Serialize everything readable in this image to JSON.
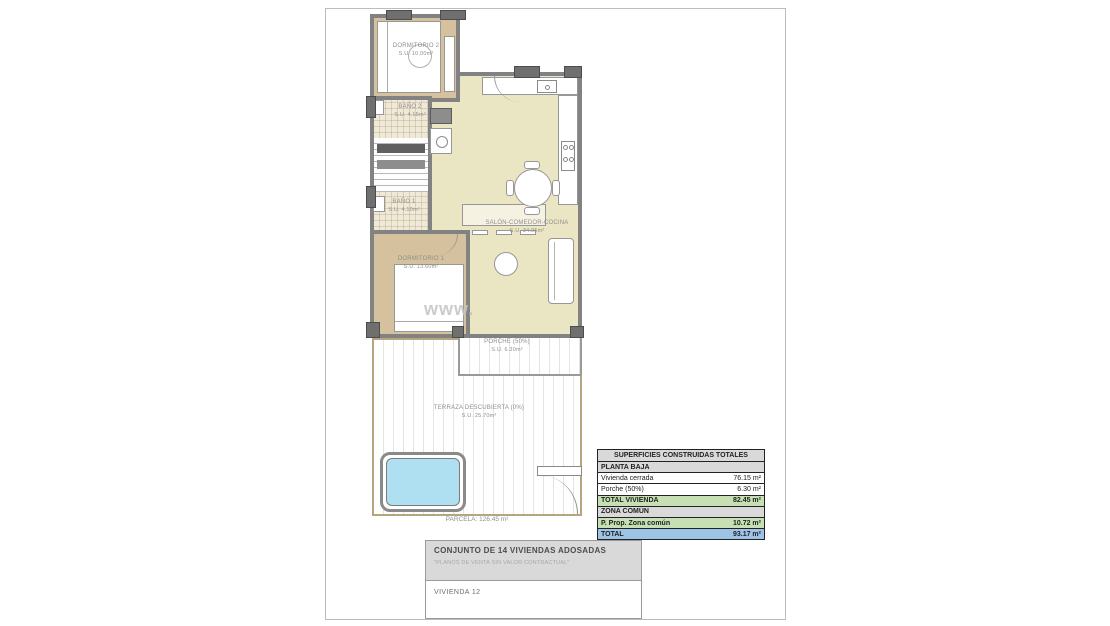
{
  "watermark": {
    "text": "www."
  },
  "plan": {
    "rooms": [
      {
        "name": "DORMITORIO 2",
        "area": "S.U. 10.00m²"
      },
      {
        "name": "BAÑO 2",
        "area": "S.U. 4.15m²"
      },
      {
        "name": "BAÑO 1",
        "area": "S.U. 4.10m²"
      },
      {
        "name": "SALÓN-COMEDOR-COCINA",
        "area": "S.U. 34.05m²"
      },
      {
        "name": "DORMITORIO 1",
        "area": "S.U. 13.60m²"
      },
      {
        "name": "PORCHE (50%)",
        "area": "S.U. 6.30m²"
      },
      {
        "name": "TERRAZA DESCUBIERTA (0%)",
        "area": "S.U. 25.70m²"
      }
    ],
    "parcela_label": "PARCELA: 126.45 m²"
  },
  "areas_table": {
    "header": "SUPERFICIES CONSTRUIDAS TOTALES",
    "rows": [
      {
        "label": "PLANTA BAJA",
        "value": ""
      },
      {
        "label": "Vivienda cerrada",
        "value": "76.15 m²"
      },
      {
        "label": "Porche (50%)",
        "value": "6.30 m²"
      },
      {
        "label": "TOTAL VIVIENDA",
        "value": "82.45 m²"
      },
      {
        "label": "ZONA COMÚN",
        "value": ""
      },
      {
        "label": "P. Prop. Zona común",
        "value": "10.72 m²"
      },
      {
        "label": "TOTAL",
        "value": "93.17 m²"
      }
    ]
  },
  "title_block": {
    "project": "CONJUNTO DE 14 VIVIENDAS ADOSADAS",
    "disclaimer": "\"PLANOS DE VENTA SIN VALOR CONTRACTUAL\"",
    "unit": "VIVIENDA 12"
  },
  "colors": {
    "bedroom_floor": "#d5c19d",
    "living_floor": "#eae5c3",
    "pool": "#aee0f2",
    "table_green": "#c6e0b4",
    "table_blue": "#9dc3e6",
    "table_gray": "#d9d9d9"
  }
}
